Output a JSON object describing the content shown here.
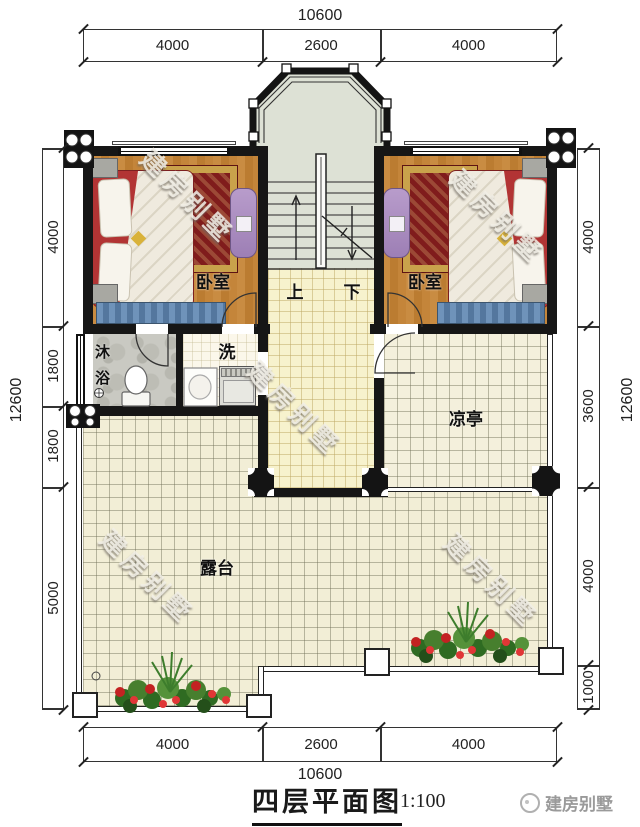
{
  "dimensions": {
    "top": {
      "total": "10600",
      "segments": [
        "4000",
        "2600",
        "4000"
      ]
    },
    "bottom": {
      "total": "10600",
      "segments": [
        "4000",
        "2600",
        "4000"
      ]
    },
    "left": {
      "total": "12600",
      "segments": [
        "4000",
        "1800",
        "1800",
        "5000"
      ]
    },
    "right": {
      "total": "12600",
      "segments": [
        "4000",
        "3600",
        "4000",
        "1000"
      ]
    }
  },
  "rooms": {
    "bedroom_left": "卧室",
    "bedroom_right": "卧室",
    "shower": "沐浴",
    "wash": "洗",
    "stairs_up": "上",
    "stairs_down": "下",
    "pavilion": "凉亭",
    "terrace": "露台"
  },
  "watermark": {
    "text": "建房别墅"
  },
  "title_block": {
    "title": "四层平面图",
    "scale": "1:100",
    "brand": "建房别墅"
  },
  "colors": {
    "wall": "#161616",
    "wood_floor": "#c08138",
    "terrace_tile": "#f2eed6",
    "hall_tile": "#f7f2cd",
    "stair_floor": "#dde1d5",
    "rug_red": "#801c1c",
    "wardrobe_purple": "#ab8dc1",
    "bench_blue": "#6f93ba",
    "flower_red": "#c32222",
    "plant_green": "#477f2e"
  }
}
